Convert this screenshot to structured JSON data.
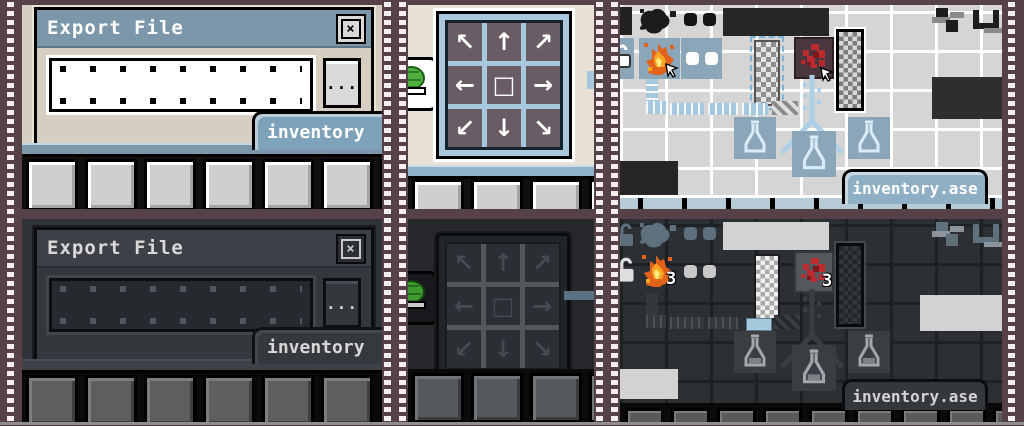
{
  "export_dialog": {
    "title": "Export File",
    "close_glyph": "×",
    "browse_label": "...",
    "tab_label": "inventory"
  },
  "canvas": {
    "tab_label": "inventory.ase"
  },
  "arrow_pad": {
    "glyphs": [
      "↖",
      "↑",
      "↗",
      "←",
      "□",
      "→",
      "↙",
      "↓",
      "↘"
    ]
  },
  "counts": {
    "fire_stack": "3",
    "splat_stack": "3"
  },
  "colors": {
    "film_maroon": "#564149",
    "light_titlebar": "#7b97a9",
    "light_body": "#d6cfc1",
    "light_canvas": "#e7e2d5",
    "tab_blue": "#8fb0c4",
    "inventory_cell_blue": "#8ba6b8",
    "pipe_blue": "#a5c8df",
    "pad_mauve": "#6a5c64",
    "pad_grid_blue": "#a9c7dd",
    "dark_titlebar": "#3d4046",
    "dark_body": "#34373c",
    "dark_canvas": "#26282c",
    "dark_cell": "#2c2f33",
    "flame_orange": "#e2621b",
    "splat_red": "#b92b2f",
    "shell_green": "#4fae3c"
  }
}
